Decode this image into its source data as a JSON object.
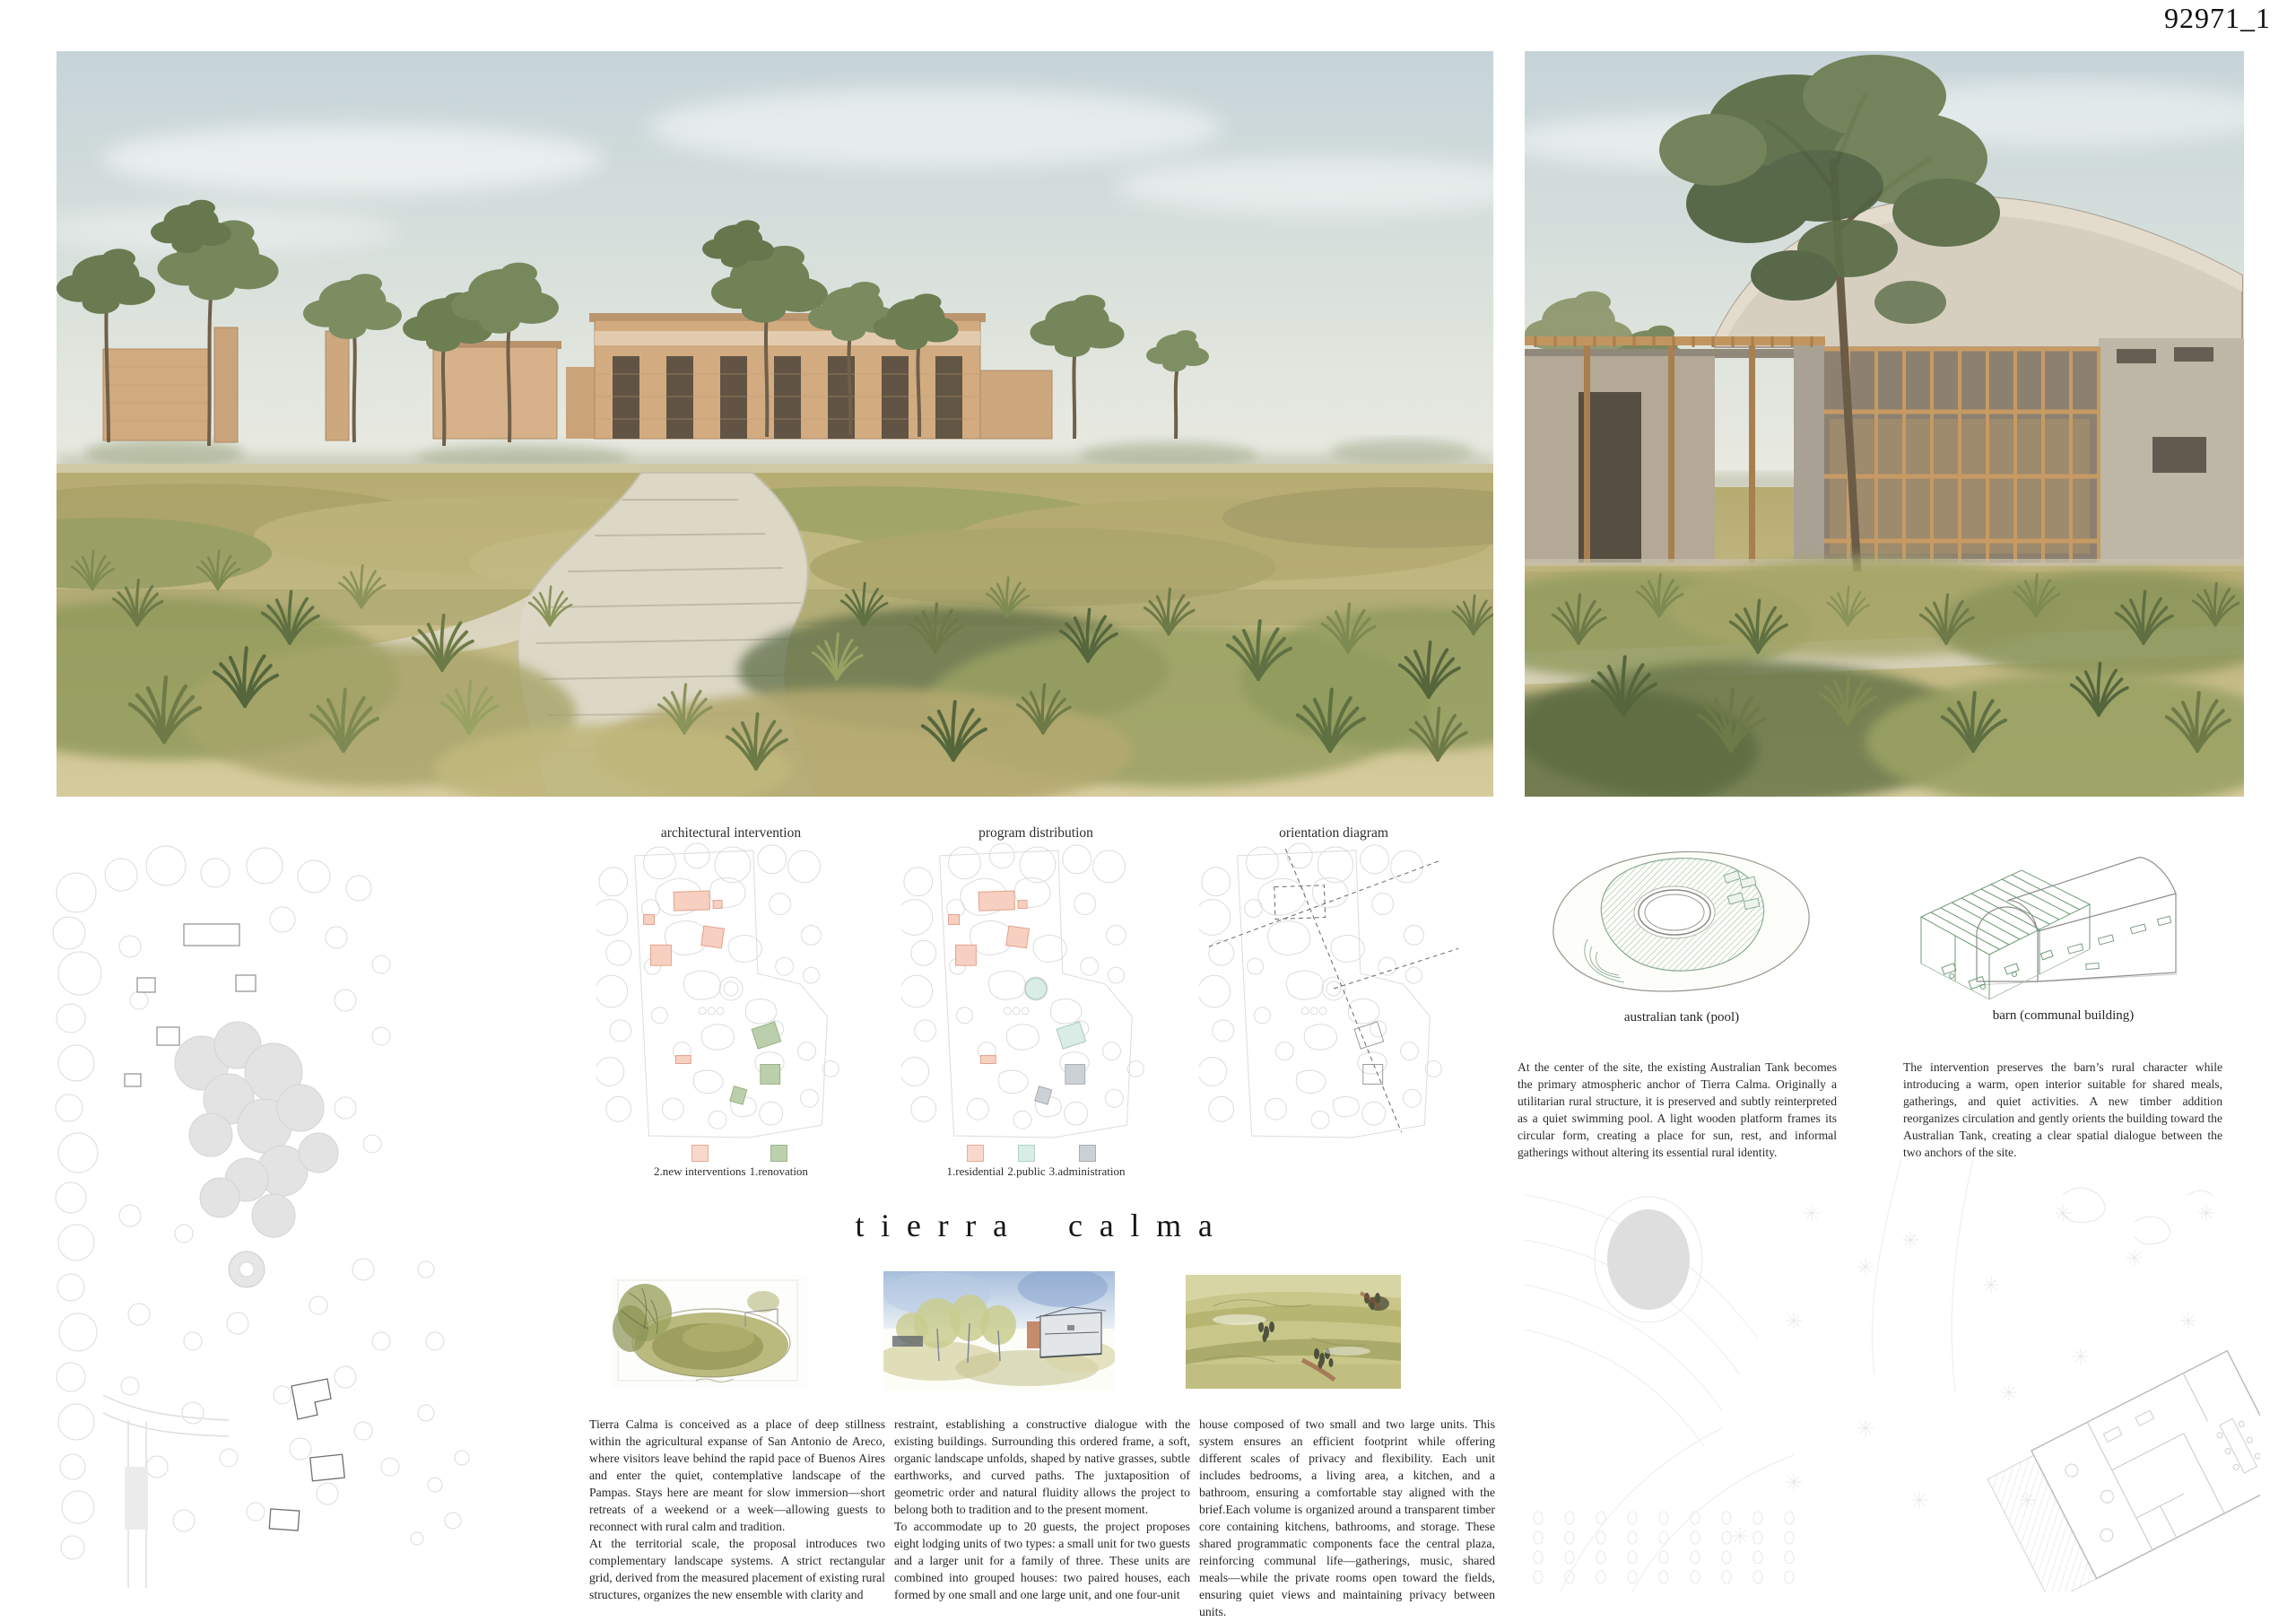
{
  "board_id": "92971_1",
  "title": "tierra calma",
  "diagrams": {
    "intervention": {
      "label": "architectural intervention"
    },
    "program": {
      "label": "program distribution"
    },
    "orientation": {
      "label": "orientation diagram"
    }
  },
  "legends": {
    "intervention": [
      {
        "label": "2.new interventions",
        "style": "background:#f9d8cb;border:1px solid #e7ac97"
      },
      {
        "label": "1.renovation",
        "style": "background:#bdd0ae;border:1px solid #9cb689"
      }
    ],
    "program": [
      {
        "label": "1.residential",
        "style": "background:#f9d8cb;border:1px solid #e7ac97"
      },
      {
        "label": "2.public",
        "style": "background:#d9ece5;border:1px solid #b0d1c2"
      },
      {
        "label": "3.administration",
        "style": "background:#ccd1d6;border:1px solid #a9aeb4"
      }
    ]
  },
  "axons": {
    "tank_caption": "australian tank (pool)",
    "tank_text": "At the center of the site, the existing Australian Tank becomes the primary atmospheric anchor of Tierra Calma. Originally a utilitarian rural structure, it is preserved and subtly reinterpreted as a quiet swimming pool. A light wooden platform frames its circular form, creating a place for sun, rest, and informal gatherings without altering its essential rural identity.",
    "barn_caption": "barn (communal building)",
    "barn_text": "The intervention preserves the barn’s rural character while introducing a warm, open interior suitable for shared meals, gatherings, and quiet activities. A new timber addition reorganizes circulation and gently orients the building toward the Australian Tank, creating a clear spatial dialogue between the two anchors of the site."
  },
  "columns": {
    "c1": [
      "Tierra Calma is conceived as a place of deep stillness within the agricultural expanse of San Antonio de Areco, where visitors leave behind the rapid pace of Buenos Aires and enter the quiet, contemplative landscape of the Pampas. Stays here are meant for slow immersion—short retreats of a weekend or a week—allowing guests to reconnect with rural calm and tradition.",
      "At the territorial scale, the proposal introduces two complementary landscape systems. A strict rectangular grid, derived from the measured placement of existing rural structures, organizes the new ensemble with clarity and"
    ],
    "c2": [
      "restraint, establishing a constructive dialogue with the existing buildings. Surrounding this ordered frame, a soft, organic landscape unfolds, shaped by native grasses, subtle earthworks, and curved paths. The juxtaposition of geometric order and natural fluidity allows the project to belong both to tradition and to the present moment.",
      "To accommodate up to 20 guests, the project proposes eight lodging units of two types: a small unit for two guests and a larger unit for a family of three. These units are combined into grouped houses: two paired houses, each formed by one small and one large unit, and one four-unit"
    ],
    "c3": [
      "house composed of two small and two large units. This system ensures an efficient footprint while offering different scales of privacy and flexibility. Each unit includes bedrooms, a living area, a kitchen, and a bathroom, ensuring a comfortable stay aligned with the brief.Each volume is organized around a transparent timber core containing kitchens, bathrooms, and storage. These shared programmatic components face the central plaza, reinforcing communal life—gatherings, music, shared meals—while the private rooms open toward the fields, ensuring quiet views and maintaining privacy between units."
    ]
  },
  "colors": {
    "new_intervention_pink": "#f9d8cb",
    "renovation_green": "#bdd0ae",
    "public_teal": "#d9ece5",
    "administration_grey": "#ccd1d6",
    "earth_wall": "#d3a97e",
    "timber": "#c79a64",
    "grass_olive": "#b0a76d",
    "axon_green": "#7fa186"
  }
}
